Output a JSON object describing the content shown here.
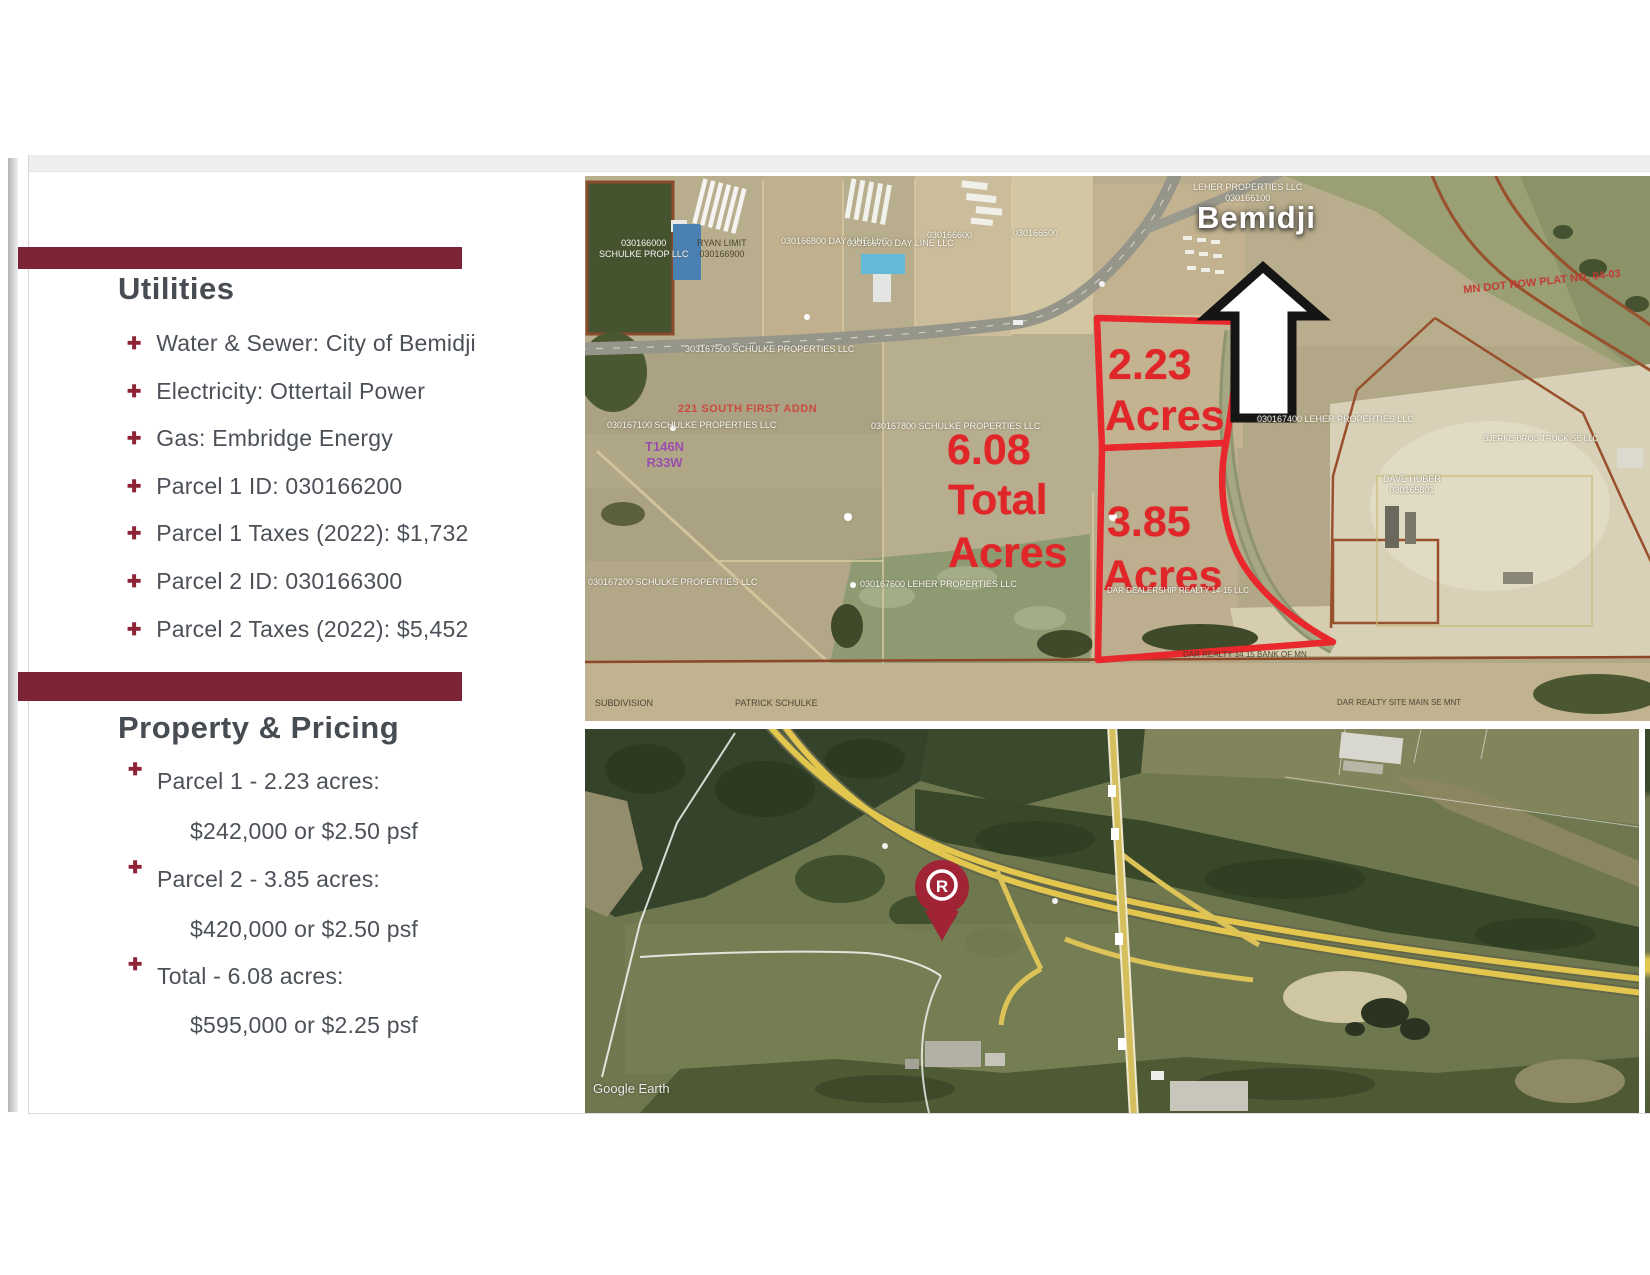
{
  "theme": {
    "accent": "#7d2536",
    "bullet_color": "#8e2236",
    "text_color": "#4c5158",
    "overlay_red": "#e02629",
    "pin_color": "#a12336"
  },
  "left_panel": {
    "bullet_glyph": "✚",
    "utilities": {
      "title": "Utilities",
      "items": [
        "Water & Sewer: City of Bemidji",
        "Electricity: Ottertail Power",
        "Gas: Embridge Energy",
        "Parcel 1 ID: 030166200",
        "Parcel 1 Taxes (2022): $1,732",
        "Parcel 2 ID: 030166300",
        "Parcel 2 Taxes (2022): $5,452"
      ]
    },
    "pricing": {
      "title": "Property & Pricing",
      "items": [
        {
          "label": "Parcel 1 - 2.23 acres:",
          "price": "$242,000 or $2.50 psf"
        },
        {
          "label": "Parcel 2 - 3.85 acres:",
          "price": "$420,000 or $2.50 psf"
        },
        {
          "label": "Total - 6.08 acres:",
          "price": "$595,000 or $2.25 psf"
        }
      ]
    }
  },
  "top_map": {
    "city_label": "Bemidji",
    "parcel1": {
      "line1": "2.23",
      "line2": "Acres"
    },
    "parcel2": {
      "line1": "3.85",
      "line2": "Acres"
    },
    "total": {
      "line1": "6.08",
      "line2": "Total",
      "line3": "Acres"
    },
    "plat_label": "221 SOUTH FIRST ADDN",
    "township": "T146N",
    "range": "R33W",
    "row_plat": "MN DOT ROW PLAT NO. 04-03",
    "labels": {
      "a1": "RYAN LIMIT",
      "a2": "030166900",
      "b": "030166800  DAY LINE LLC",
      "c": "030166700  DAY LINE LLC",
      "d": "030166600",
      "e": "030166500",
      "f1": "030166000",
      "f2": "SCHULKE PROP LLC",
      "g1": "LEHER PROPERTIES LLC",
      "g2": "030166100",
      "road": "303167500   SCHULKE PROPERTIES LLC",
      "i": "030167100  SCHULKE PROPERTIES LLC",
      "j": "030167800  SCHULKE PROPERTIES LLC",
      "k": "030167400  LEHER PROPERTIES LLC",
      "l": "030167200   SCHULKE PROPERTIES LLC",
      "m": "030167600   LEHER PROPERTIES LLC",
      "n": "DAR DEALERSHIP REALTY 14-15 LLC",
      "o": "PATRICK SCHULKE",
      "p": "SUBDIVISION",
      "q": "DAR REALTY 14 15 BANK OF MN",
      "r1": "DAVE HUBER",
      "r2": "030165801",
      "s": "BJERKE BROS TRUCK SE LLC",
      "x": "DAR REALTY SITE MAIN SE MNT"
    }
  },
  "bottom_map": {
    "watermark": "Google Earth",
    "pin_letter": "R"
  }
}
